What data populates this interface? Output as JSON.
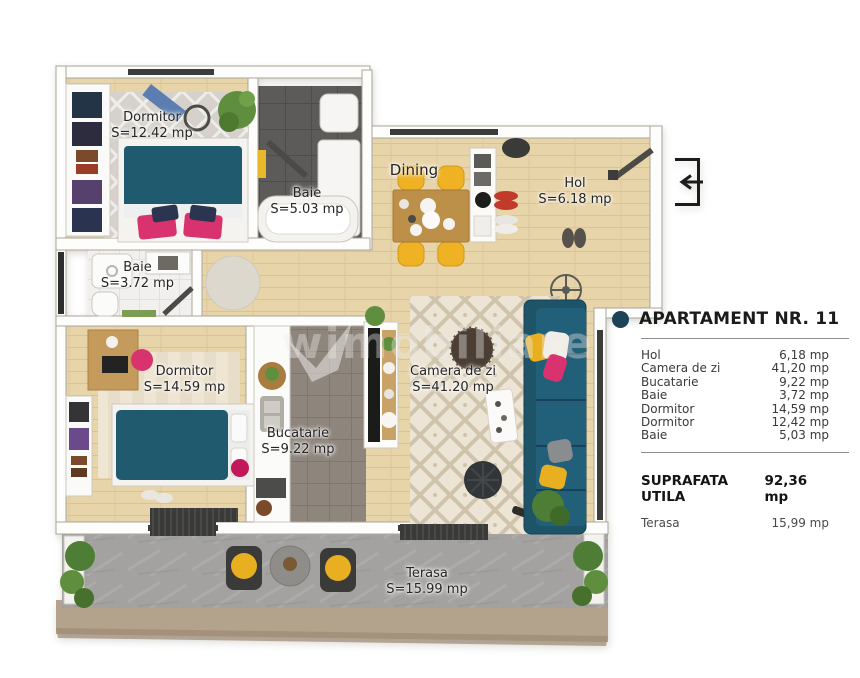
{
  "plan": {
    "rooms": [
      {
        "name": "Dormitor",
        "area": "S=12.42 mp"
      },
      {
        "name": "Baie",
        "area": "S=5.03 mp"
      },
      {
        "name": "Dining",
        "area": ""
      },
      {
        "name": "Hol",
        "area": "S=6.18 mp"
      },
      {
        "name": "Baie",
        "area": "S=3.72 mp"
      },
      {
        "name": "Dormitor",
        "area": "S=14.59 mp"
      },
      {
        "name": "Bucatarie",
        "area": "S=9.22 mp"
      },
      {
        "name": "Camera de zi",
        "area": "S=41.20 mp"
      },
      {
        "name": "Terasa",
        "area": "S=15.99 mp"
      }
    ],
    "watermark": "wimobiliare"
  },
  "panel": {
    "title": "APARTAMENT NR. 11",
    "bullet_color": "#1d4356",
    "rows": [
      {
        "label": "Hol",
        "value": "6,18 mp"
      },
      {
        "label": "Camera de zi",
        "value": "41,20 mp"
      },
      {
        "label": "Bucatarie",
        "value": "9,22 mp"
      },
      {
        "label": "Baie",
        "value": "3,72 mp"
      },
      {
        "label": "Dormitor",
        "value": "14,59 mp"
      },
      {
        "label": "Dormitor",
        "value": "12,42 mp"
      },
      {
        "label": "Baie",
        "value": "5,03 mp"
      }
    ],
    "total": {
      "label": "SUPRAFATA UTILA",
      "value": "92,36 mp"
    },
    "terrace_row": {
      "label": "Terasa",
      "value": "15,99 mp"
    }
  }
}
